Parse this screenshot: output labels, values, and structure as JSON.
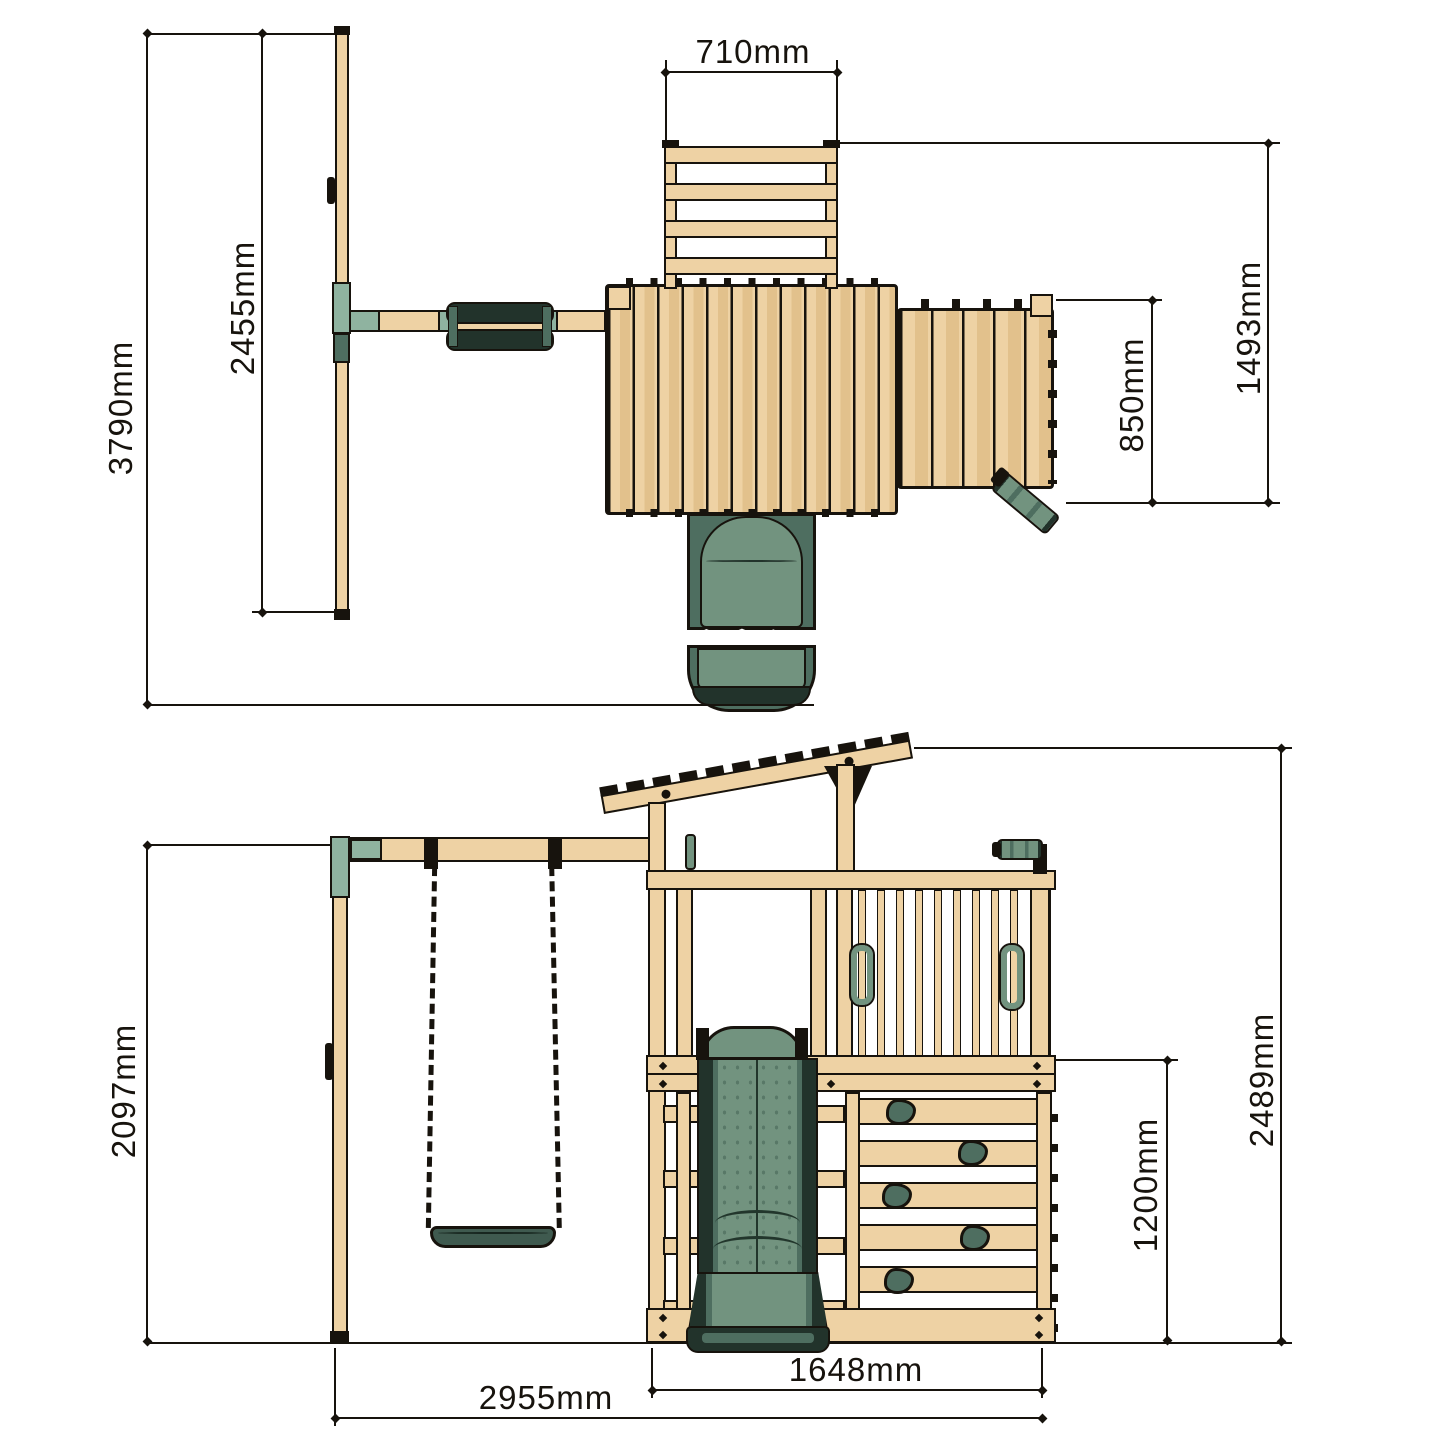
{
  "title": "wooden-playcentre-dimension-diagram",
  "views": {
    "top": {
      "name": "plan view",
      "dimensions": {
        "overall_depth": "3790mm",
        "swing_frame_width": "2455mm",
        "ladder_width": "710mm",
        "deck_depth": "850mm",
        "tower_depth": "1493mm"
      }
    },
    "front": {
      "name": "front elevation",
      "dimensions": {
        "swing_beam_height": "2097mm",
        "climbing_wall_height": "1200mm",
        "overall_height": "2489mm",
        "tower_width": "1648mm",
        "overall_width": "2955mm"
      }
    }
  },
  "colors": {
    "wood": "#eed2a4",
    "wood_shade": "#e2c18c",
    "outline": "#17130d",
    "slide_dark": "#22332b",
    "slide_mid": "#4e6e60",
    "slide_light": "#72937f",
    "bracket_sage": "#8fb3a0",
    "seat_green": "#3f5a4f"
  }
}
